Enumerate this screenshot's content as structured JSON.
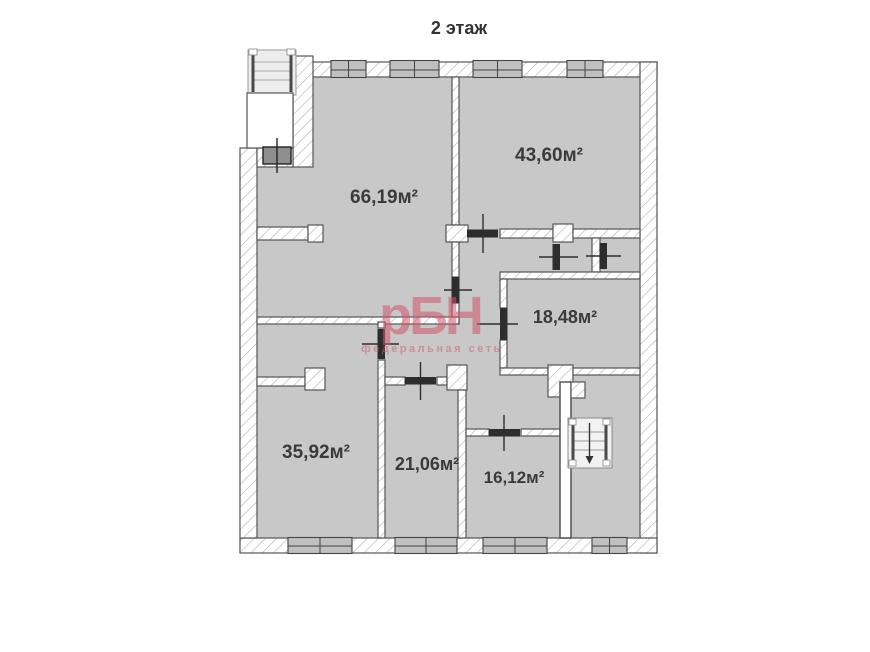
{
  "title": "2 этаж",
  "watermark": {
    "brand": "рБН",
    "subtitle": "федеральная сеть"
  },
  "rooms": [
    {
      "id": "room-top-center",
      "area": "66,19м²"
    },
    {
      "id": "room-top-right",
      "area": "43,60м²"
    },
    {
      "id": "room-middle-right",
      "area": "18,48м²"
    },
    {
      "id": "room-bottom-left",
      "area": "35,92м²"
    },
    {
      "id": "room-bottom-center",
      "area": "21,06м²"
    },
    {
      "id": "room-bottom-right",
      "area": "16,12м²"
    }
  ],
  "stairs": {
    "exterior_top_left": "entrance-stairs",
    "interior_bottom_right": "stairwell-down"
  },
  "colors": {
    "background": "#ffffff",
    "room_fill": "#c8c8c8",
    "wall_fill": "#ffffff",
    "wall_outline": "#555555",
    "door": "#2d2d2d",
    "window_fill": "#c0c0c0",
    "label_text": "#3a3a3a",
    "watermark": "#d2556c"
  }
}
